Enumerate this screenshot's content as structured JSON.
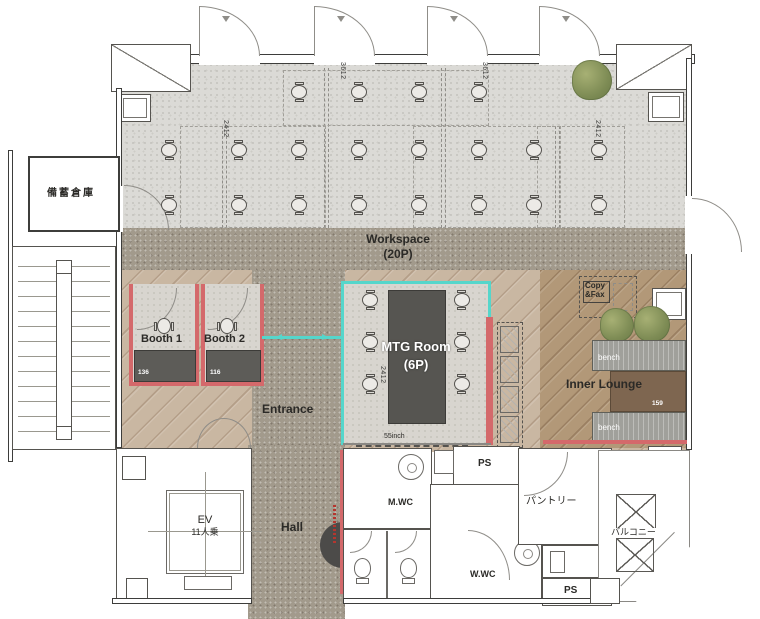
{
  "floorplan": {
    "storage_label": "備蓄倉庫",
    "workspace": {
      "name": "Workspace",
      "capacity": "(20P)"
    },
    "dims": {
      "d3612_a": "3612",
      "d3612_b": "3612",
      "d2412_a": "2412",
      "d2412_b": "2412"
    },
    "booth1": {
      "name": "Booth 1",
      "number": "136"
    },
    "booth2": {
      "name": "Booth 2",
      "number": "116"
    },
    "entrance_label": "Entrance",
    "mtg": {
      "name": "MTG Room",
      "capacity": "(6P)",
      "display": "55inch",
      "dim": "2412"
    },
    "copyfax": {
      "line1": "Copy",
      "line2": "&Fax"
    },
    "lounge": {
      "name": "Inner Lounge",
      "bench_top": "bench",
      "bench_bottom": "bench",
      "number": "159"
    },
    "ev": {
      "name": "EV",
      "capacity": "11人乗"
    },
    "hall_label": "Hall",
    "mwc_label": "M.WC",
    "wwc_label": "W.WC",
    "pantry_label": "パントリー",
    "ps_top_label": "PS",
    "ps_bottom_label": "PS",
    "balcony_label": "バルコニー",
    "colors": {
      "glass_partition": "#55d6cb",
      "accent_wall": "#d4696b"
    }
  }
}
